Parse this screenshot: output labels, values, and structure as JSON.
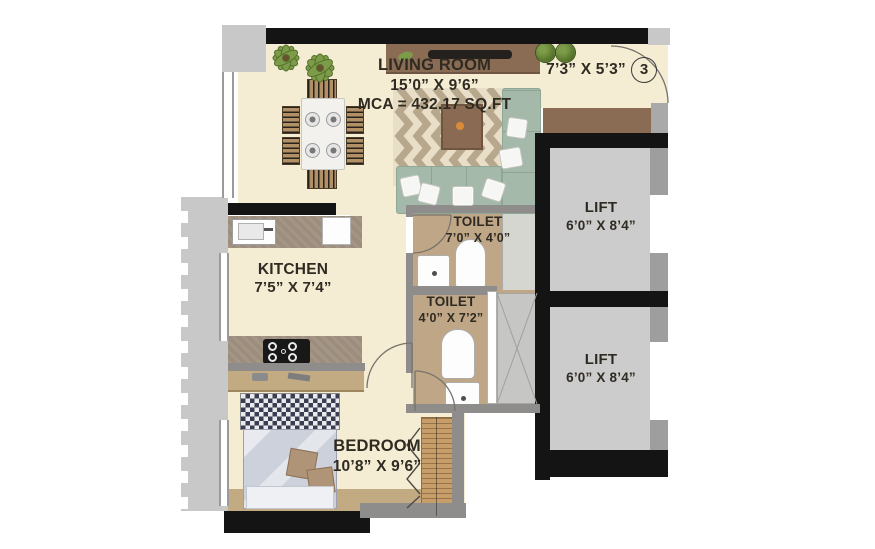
{
  "floor_plan": {
    "living_room": {
      "name": "LIVING ROOM",
      "dimensions": "15’0” X 9’6”",
      "area": "MCA = 432.17 SQ.FT"
    },
    "foyer": {
      "dimensions": "7’3” X 5’3”",
      "door_number": "3"
    },
    "lift_1": {
      "name": "LIFT",
      "dimensions": "6’0” X 8’4”"
    },
    "lift_2": {
      "name": "LIFT",
      "dimensions": "6’0” X 8’4”"
    },
    "toilet_1": {
      "name": "TOILET",
      "dimensions": "7’0” X 4’0”"
    },
    "toilet_2": {
      "name": "TOILET",
      "dimensions": "4’0” X 7’2”"
    },
    "kitchen": {
      "name": "KITCHEN",
      "dimensions": "7’5” X 7’4”"
    },
    "bedroom": {
      "name": "BEDROOM",
      "dimensions": "10’8” X 9’6”"
    }
  },
  "colors": {
    "floor": "#f4ecd3",
    "floor_tan": "#bfa687",
    "wall_black": "#141414",
    "wall_gray": "#8e8d8b",
    "exterior_gray": "#c8c8c8",
    "lift_gray": "#cccccc",
    "jamb_gray": "#9e9e9e",
    "sofa_green": "#a4b9a9",
    "sofa_green_dark": "#8fa795",
    "counter_gray": "#9c8d7d",
    "wood_brown": "#c79e6a",
    "console_brown": "#8a6c55",
    "tan_furniture": "#c2aa83",
    "bed_gray": "#ccd1db",
    "bed_check": "#3a3e52",
    "pillow_tan": "#b09478",
    "rug_bg": "#e9dfc8",
    "rug_stripe": "#b7a88d",
    "plant_green": "#7d9c4a",
    "plant_dark": "#55702c",
    "shower_gray": "#d6d6d0",
    "duct_gray": "#c6c6c4",
    "text_color": "#2f2b22"
  }
}
